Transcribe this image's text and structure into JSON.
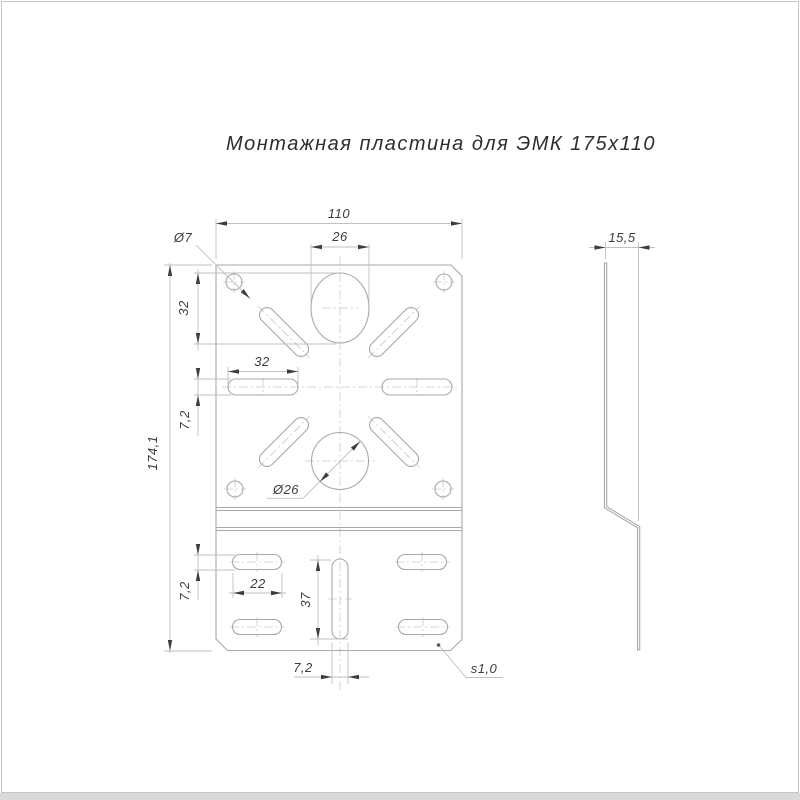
{
  "title": "Монтажная пластина для ЭМК 175х110",
  "dims": {
    "plate_width": "110",
    "oval_width": "26",
    "corner_hole_dia": "Ø7",
    "oval_height": "32",
    "upper_slot_length": "32",
    "upper_slot_width": "7,2",
    "plate_height": "174,1",
    "center_hole_dia": "Ø26",
    "lower_slot_length": "22",
    "vslot_height": "37",
    "lower_slot_width": "7,2",
    "vslot_width": "7,2",
    "thickness": "s1,0",
    "bend_offset": "15,5"
  },
  "colors": {
    "outline": "#a6aaa9",
    "dimension_lines": "#bdc1c0",
    "centerlines": "#c8cbca",
    "arrows_and_text": "#3d3d3d",
    "title_text": "#2e2e2e",
    "page_frame": "#c6c6c6",
    "background": "#ffffff"
  }
}
